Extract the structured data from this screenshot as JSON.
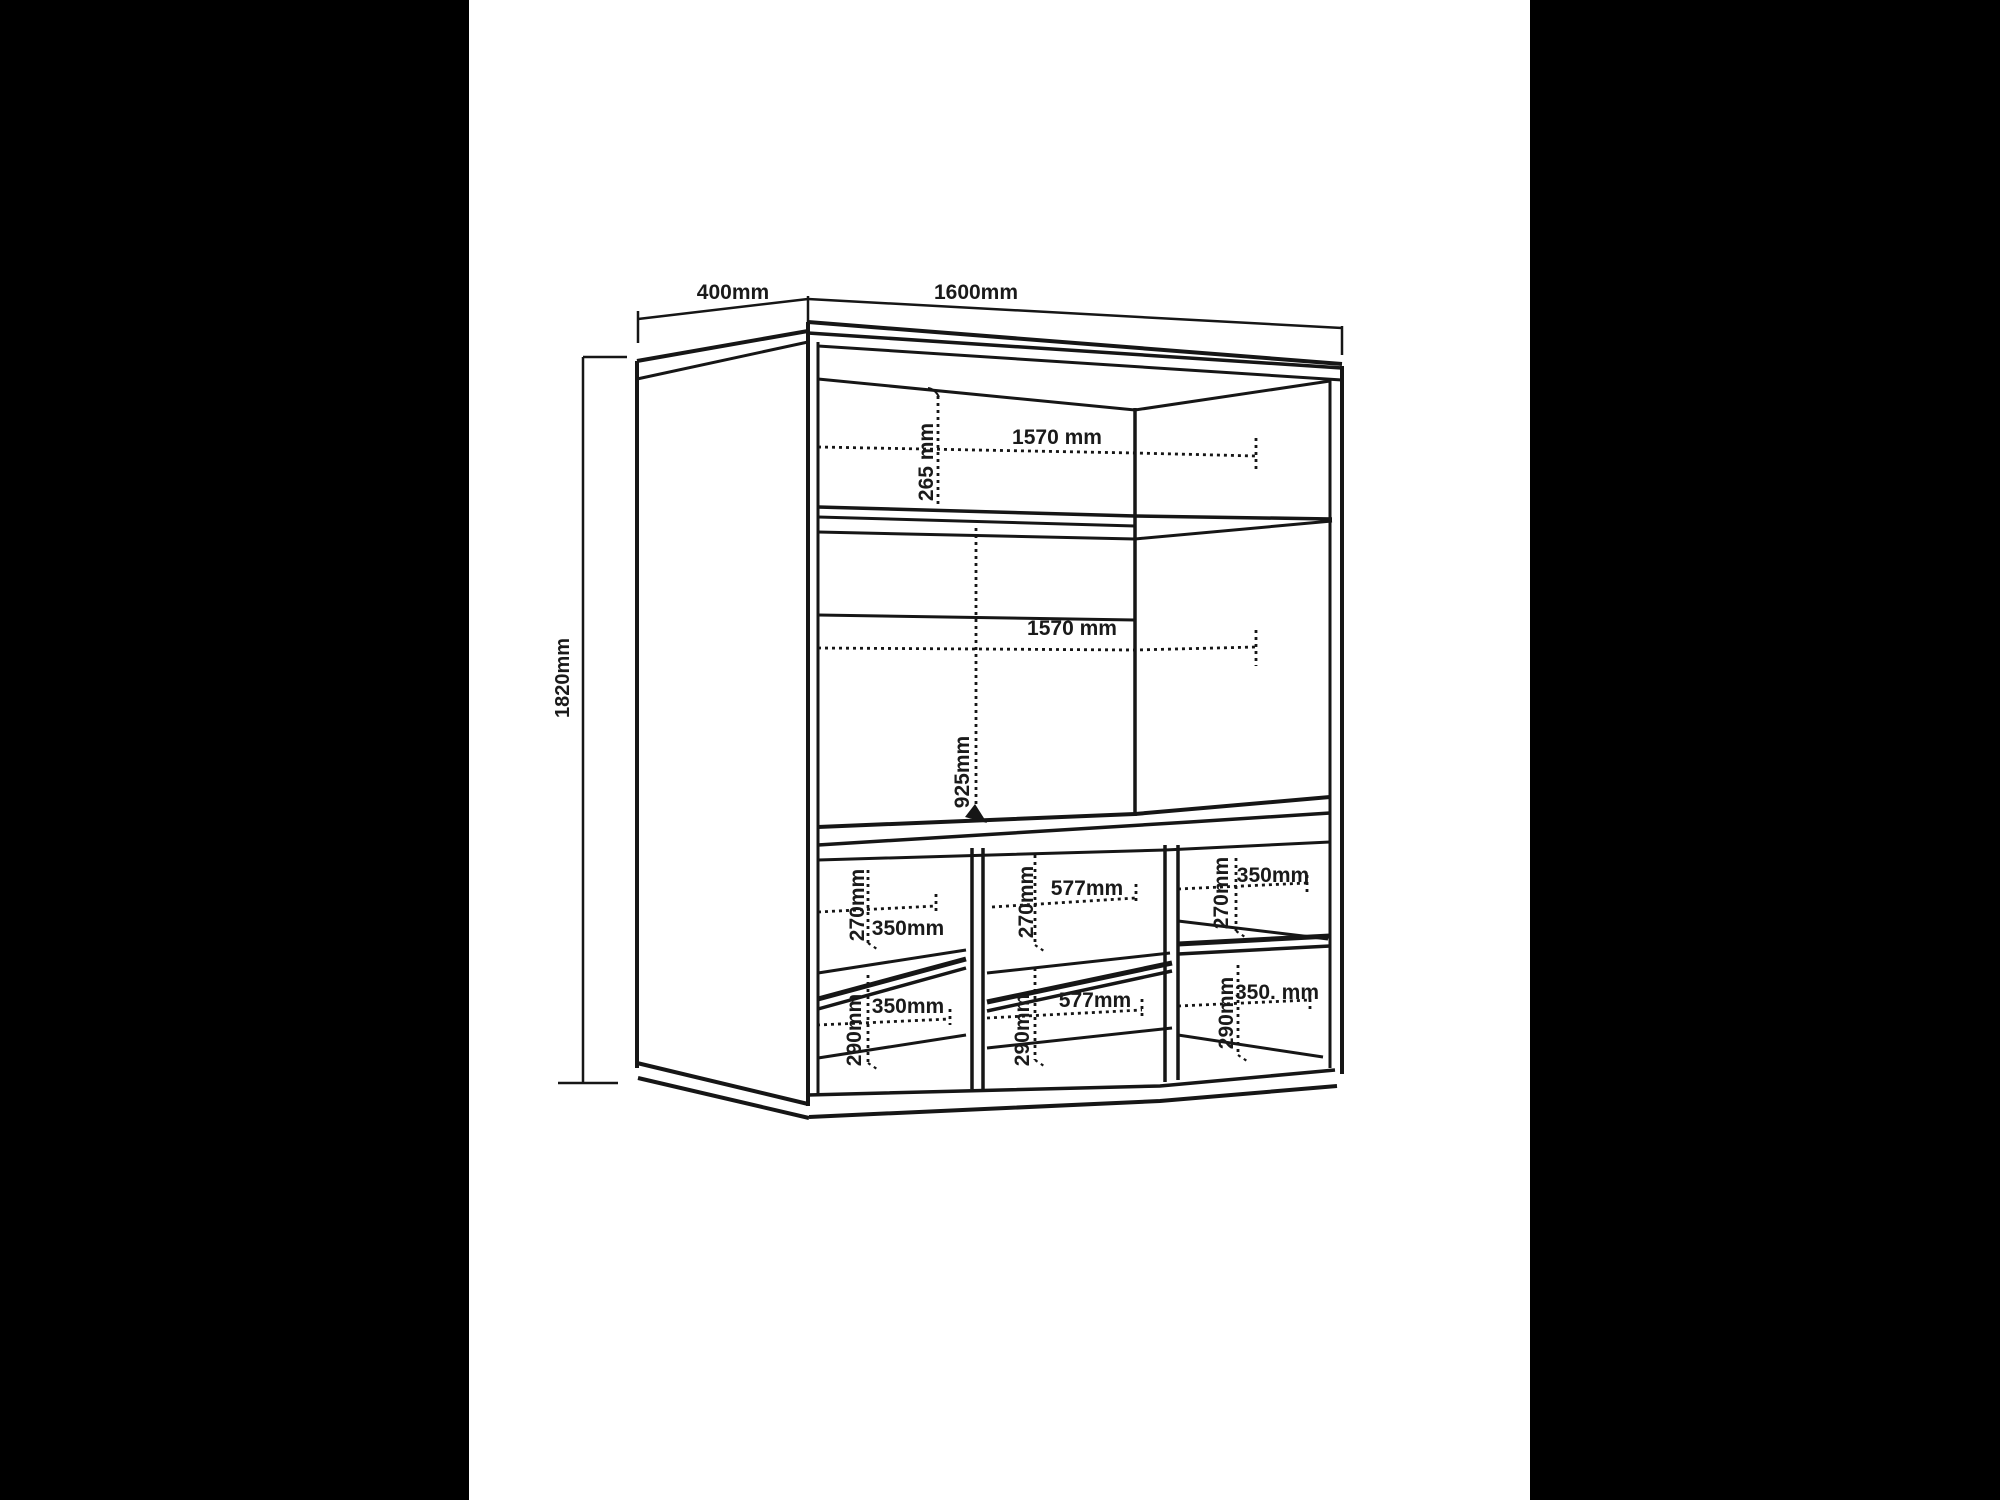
{
  "style": {
    "background_color": "#000000",
    "paper_color": "#ffffff",
    "line_color": "#161616"
  },
  "drawing": {
    "overall": {
      "depth": "400mm",
      "width": "1600mm",
      "height": "1820mm"
    },
    "top_shelf": {
      "width": "1570  mm",
      "height": "265 mm"
    },
    "middle": {
      "width": "1570 mm",
      "height": "925mm"
    },
    "cubbies": {
      "top_row": {
        "height": "270mm",
        "widths": [
          "350mm",
          "577mm",
          "350mm"
        ]
      },
      "bottom_row": {
        "height": "290mm",
        "widths": [
          "350mm",
          "577mm",
          "350. mm"
        ]
      }
    }
  }
}
